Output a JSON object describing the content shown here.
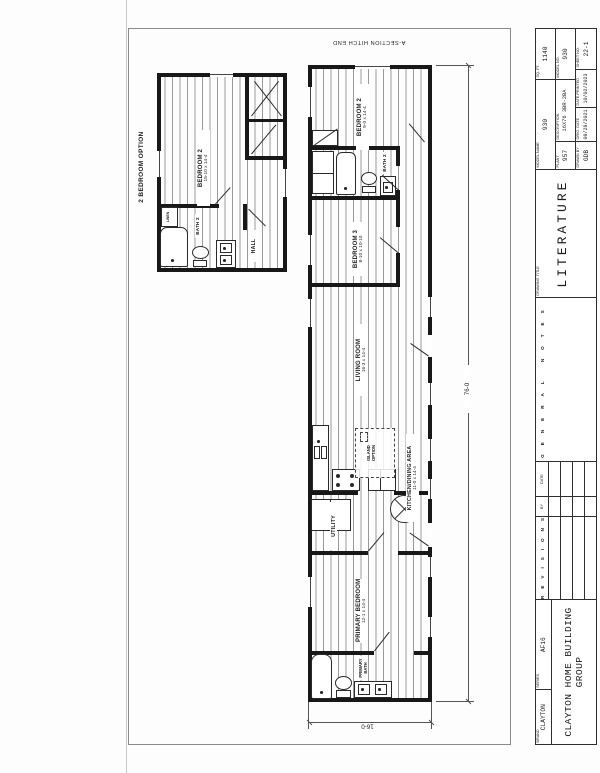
{
  "page": {
    "section_label": "A-SECTION HITCH END",
    "dim_length": "76-0",
    "dim_width": "16-0"
  },
  "title_block": {
    "brand_label": "BRAND",
    "brand": "CLAYTON",
    "series_label": "SERIES",
    "series": "AF16",
    "company": "CLAYTON HOME BUILDING GROUP",
    "revisions_title": "REVISIONS",
    "revisions_by": "BY",
    "revisions_date": "DATE",
    "general_notes_title": "GENERAL NOTES",
    "drawing_title_label": "DRAWING TITLE",
    "drawing_title": "LITERATURE",
    "model_name_label": "MODEL NAME",
    "model_name": "930",
    "sqft_label": "SQ. FT.",
    "sqft": "1140",
    "plant_label": "PLANT",
    "plant": "957",
    "description_label": "DESCRIPTION",
    "description": "16X76 3BR-2BA",
    "model_no_label": "MODEL NO.",
    "model_no": "930",
    "drawn_by_label": "DRAWN BY",
    "drawn_by": "GDB",
    "orig_date_label": "ORIG. DATE",
    "orig_date": "09/29/2021",
    "date_printed_label": "DATE PRINTED",
    "date_printed": "10/02/2023",
    "sheet_no_label": "SHEET NO.",
    "sheet_no": "22-1"
  },
  "main_plan": {
    "bedroom2": {
      "name": "BEDROOM 2",
      "dims": "9-0 x 14-4"
    },
    "bath2": {
      "name": "BATH 2"
    },
    "bedroom3": {
      "name": "BEDROOM 3",
      "dims": "8-10 x 10-10"
    },
    "living": {
      "name": "LIVING ROOM",
      "dims": "16-3 x 14-4"
    },
    "kitchen": {
      "name": "KITCHEN/DINING AREA",
      "dims": "11-0 x 14-4"
    },
    "island": {
      "line1": "ISLAND",
      "line2": "OPTION"
    },
    "utility": {
      "name": "UTILITY"
    },
    "primary_bedroom": {
      "name": "PRIMARY BEDROOM",
      "dims": "12-1 x 14-4"
    },
    "primary_bath": {
      "line1": "PRIMARY",
      "line2": "BATH"
    }
  },
  "option_plan": {
    "title": "2 BEDROOM OPTION",
    "bedroom2": {
      "name": "BEDROOM 2",
      "dims": "15-10 x 14-4"
    },
    "bath2": {
      "name": "BATH 2"
    },
    "hall": {
      "name": "HALL"
    },
    "linen": {
      "name": "LINEN"
    }
  }
}
